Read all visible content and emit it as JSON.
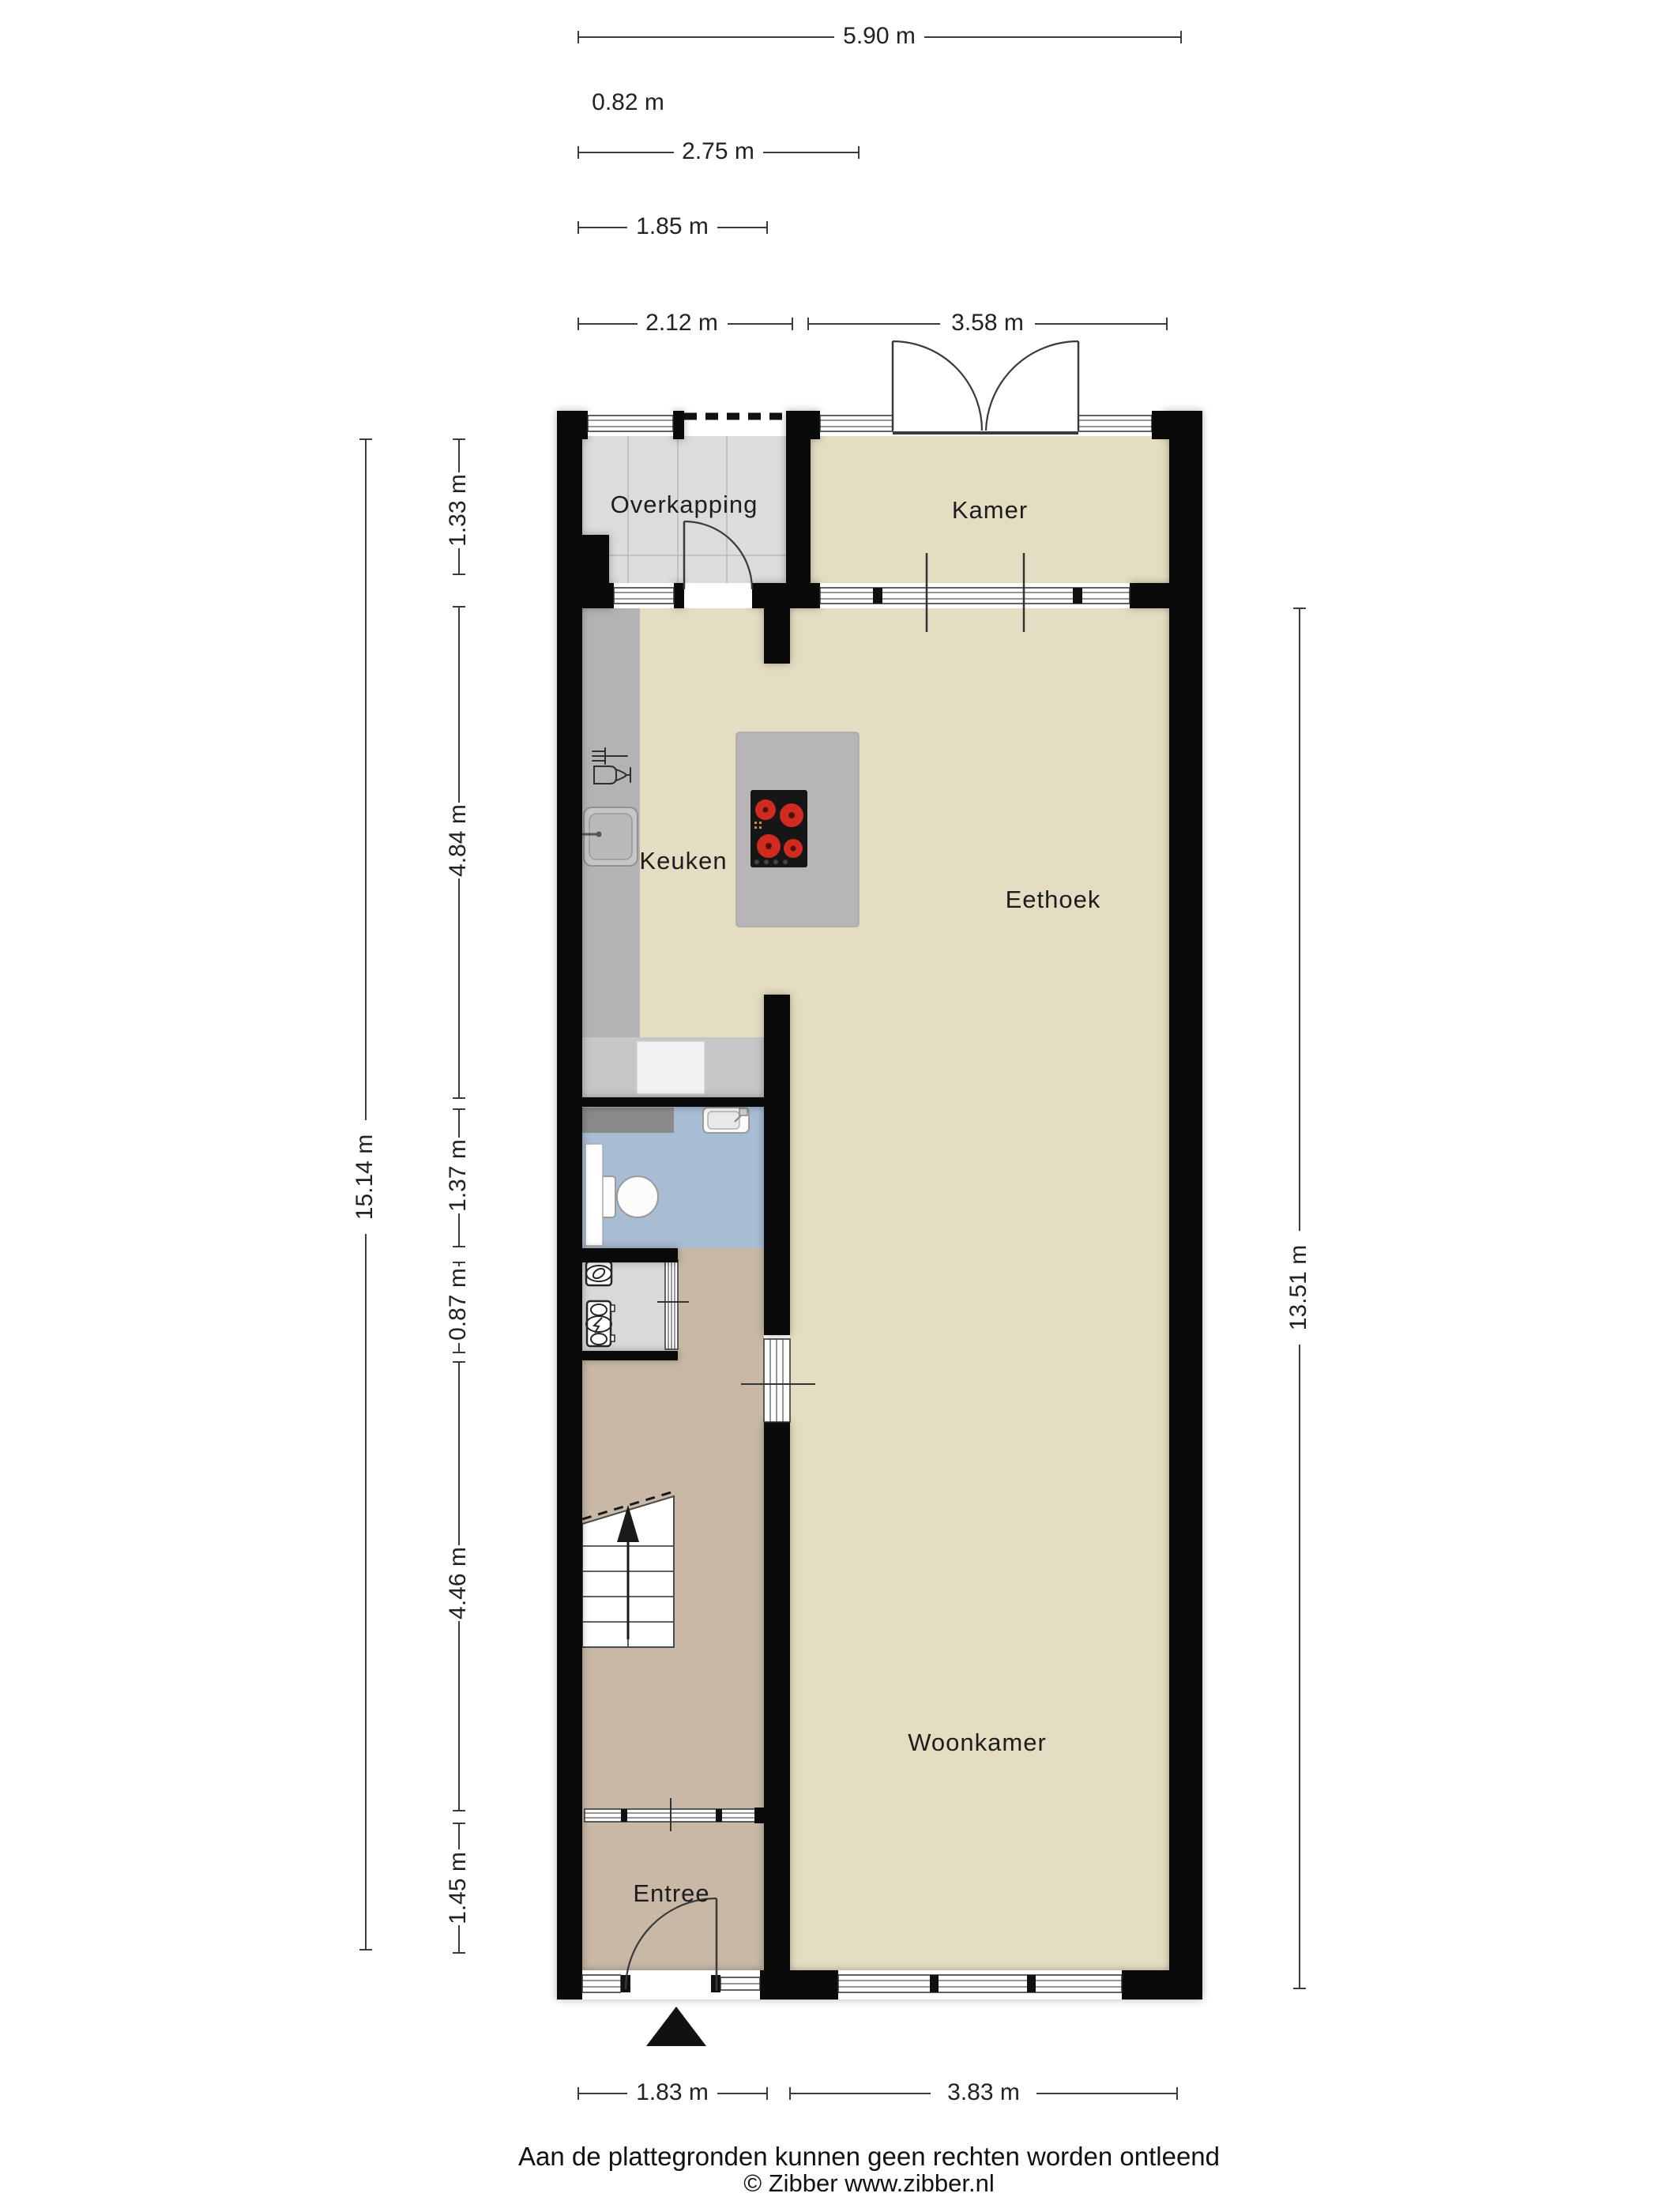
{
  "colors": {
    "wall": "#0a0a0a",
    "floor_living": "#e5ddc2",
    "floor_overkapping": "#dcdcdc",
    "floor_hall": "#c8b8a5",
    "floor_toilet": "#a8bcd4",
    "floor_utility": "#d9d9d9",
    "counter": "#b3b3b3",
    "counter_strip": "#c6c6c6",
    "island": "#b6b6b6",
    "cabinet_dark": "#8a8a8a",
    "cooktop": "#161616",
    "burner_red": "#cf2b1f",
    "text": "#1d1d1d"
  },
  "rooms": {
    "overkapping": {
      "label": "Overkapping"
    },
    "kamer": {
      "label": "Kamer"
    },
    "keuken": {
      "label": "Keuken"
    },
    "eethoek": {
      "label": "Eethoek"
    },
    "woonkamer": {
      "label": "Woonkamer"
    },
    "entree": {
      "label": "Entree"
    }
  },
  "dimensions": {
    "top": {
      "overall": "5.90 m",
      "recess": "0.82 m",
      "mid": "2.75 m",
      "small": "1.85 m",
      "overkapping_width": "2.12 m",
      "kamer_width": "3.58 m"
    },
    "left": {
      "overall": "15.14 m",
      "overkapping_depth": "1.33 m",
      "kitchen_depth": "4.84 m",
      "toilet_depth": "1.37 m",
      "utility_depth": "0.87 m",
      "hall_depth": "4.46 m",
      "entree_depth": "1.45 m"
    },
    "right": {
      "living_depth": "13.51 m"
    },
    "bottom": {
      "entree_width": "1.83 m",
      "woonkamer_width": "3.83 m"
    }
  },
  "footer": {
    "disclaimer": "Aan de plattegronden kunnen geen rechten worden ontleend",
    "copyright": "© Zibber www.zibber.nl"
  }
}
